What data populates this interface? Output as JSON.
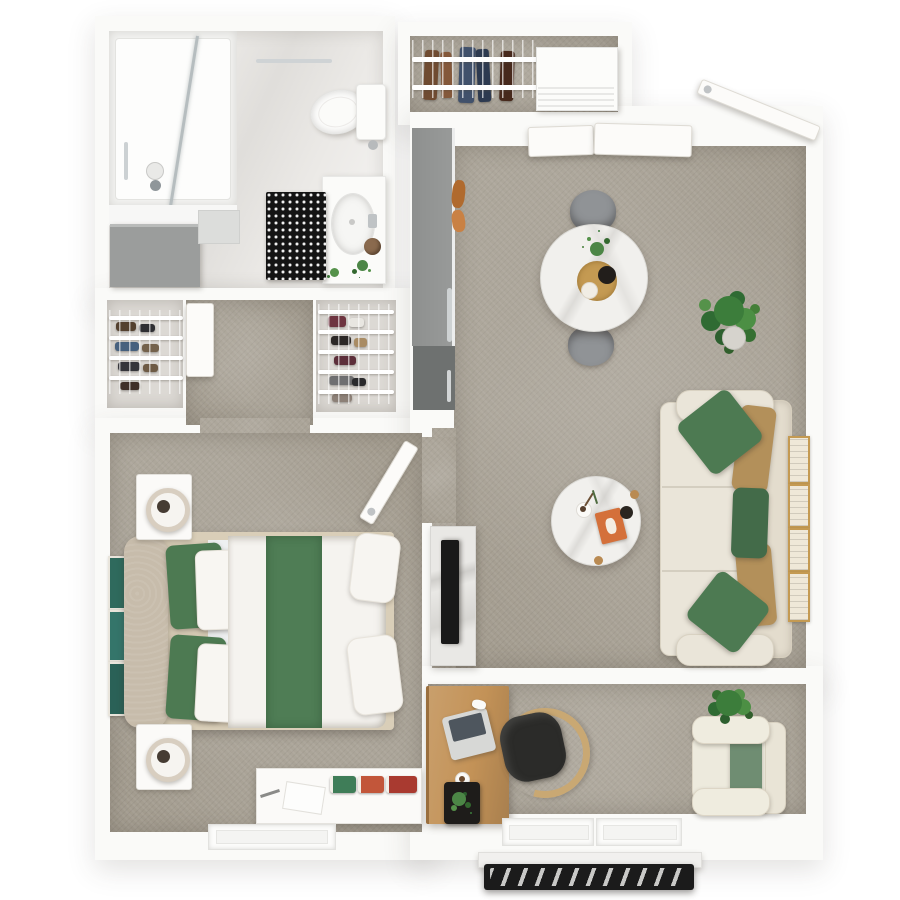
{
  "title": "One-bedroom apartment 3D floor plan, top-down view",
  "palette": {
    "wall": "#fafaf8",
    "carpet": "#a49d90",
    "carpet_light": "#b5ada1",
    "bath_floor": "#ebe9e6",
    "marble": "#f1f0ed",
    "wood": "#c99f6c",
    "wood_dark": "#a87f4e",
    "sofa_cream": "#eae5d9",
    "sofa_back": "#e3dccd",
    "pillow_green": "#4d7a52",
    "pillow_green_dark": "#436b49",
    "pillow_tan": "#b3905a",
    "headboard_beige": "#c7bcab",
    "runner_green": "#4f7d55",
    "cushion_sage": "#6f8d72",
    "tv_black": "#191919",
    "rug_black": "#141414",
    "cabinet_gray": "#8e908f",
    "cabinet_gray_dark": "#6e7170",
    "gold": "#c49a52",
    "teal_art": "#2f6a5d",
    "rail_black": "#1b1b1b",
    "plant": "#3c7d3b",
    "plant_dark": "#2c5f2e",
    "chair_gray": "#909396",
    "seat_black": "#2b2b29"
  },
  "rooms": [
    {
      "id": "bathroom",
      "label": "Bathroom",
      "items": [
        "walk-in shower",
        "glass shower screen",
        "toilet",
        "vanity with sink",
        "gray storage cabinet",
        "black-and-white patterned rug",
        "towel bar",
        "small plant"
      ]
    },
    {
      "id": "entry-closet",
      "label": "Entry closet",
      "items": [
        "wire shelving",
        "hanging clothes",
        "white drawer unit"
      ]
    },
    {
      "id": "hallway",
      "label": "Hallway",
      "items": [
        "open door panel",
        "wire storage closet left",
        "wire storage closet right"
      ]
    },
    {
      "id": "living-dining",
      "label": "Living / Dining room",
      "items": [
        "round marble dining table",
        "two gray dining chairs",
        "gold centerpiece tray with plant",
        "large potted plant",
        "three-seat cream sofa",
        "three green accent pillows",
        "two tan accent pillows",
        "round marble coffee table",
        "marble TV console",
        "flat TV",
        "four gold wall frames",
        "open entry door",
        "tall gray cabinet with fridge unit"
      ]
    },
    {
      "id": "bedroom",
      "label": "Bedroom",
      "items": [
        "queen bed with white duvet",
        "green quilted runner",
        "beige headboard",
        "two green pillows",
        "two white pillows",
        "two white nightstands",
        "two table lamps",
        "white dresser with magazines",
        "three teal wall artworks",
        "open door",
        "window"
      ]
    },
    {
      "id": "den",
      "label": "Den / Office",
      "items": [
        "wooden desk",
        "laptop",
        "coffee cup",
        "desk plant in black planter",
        "black desk chair with wood frame",
        "cream armchair",
        "sage seat cushion",
        "potted plant",
        "two windows"
      ]
    },
    {
      "id": "balcony",
      "label": "Balcony",
      "items": [
        "black metal railing"
      ]
    }
  ]
}
